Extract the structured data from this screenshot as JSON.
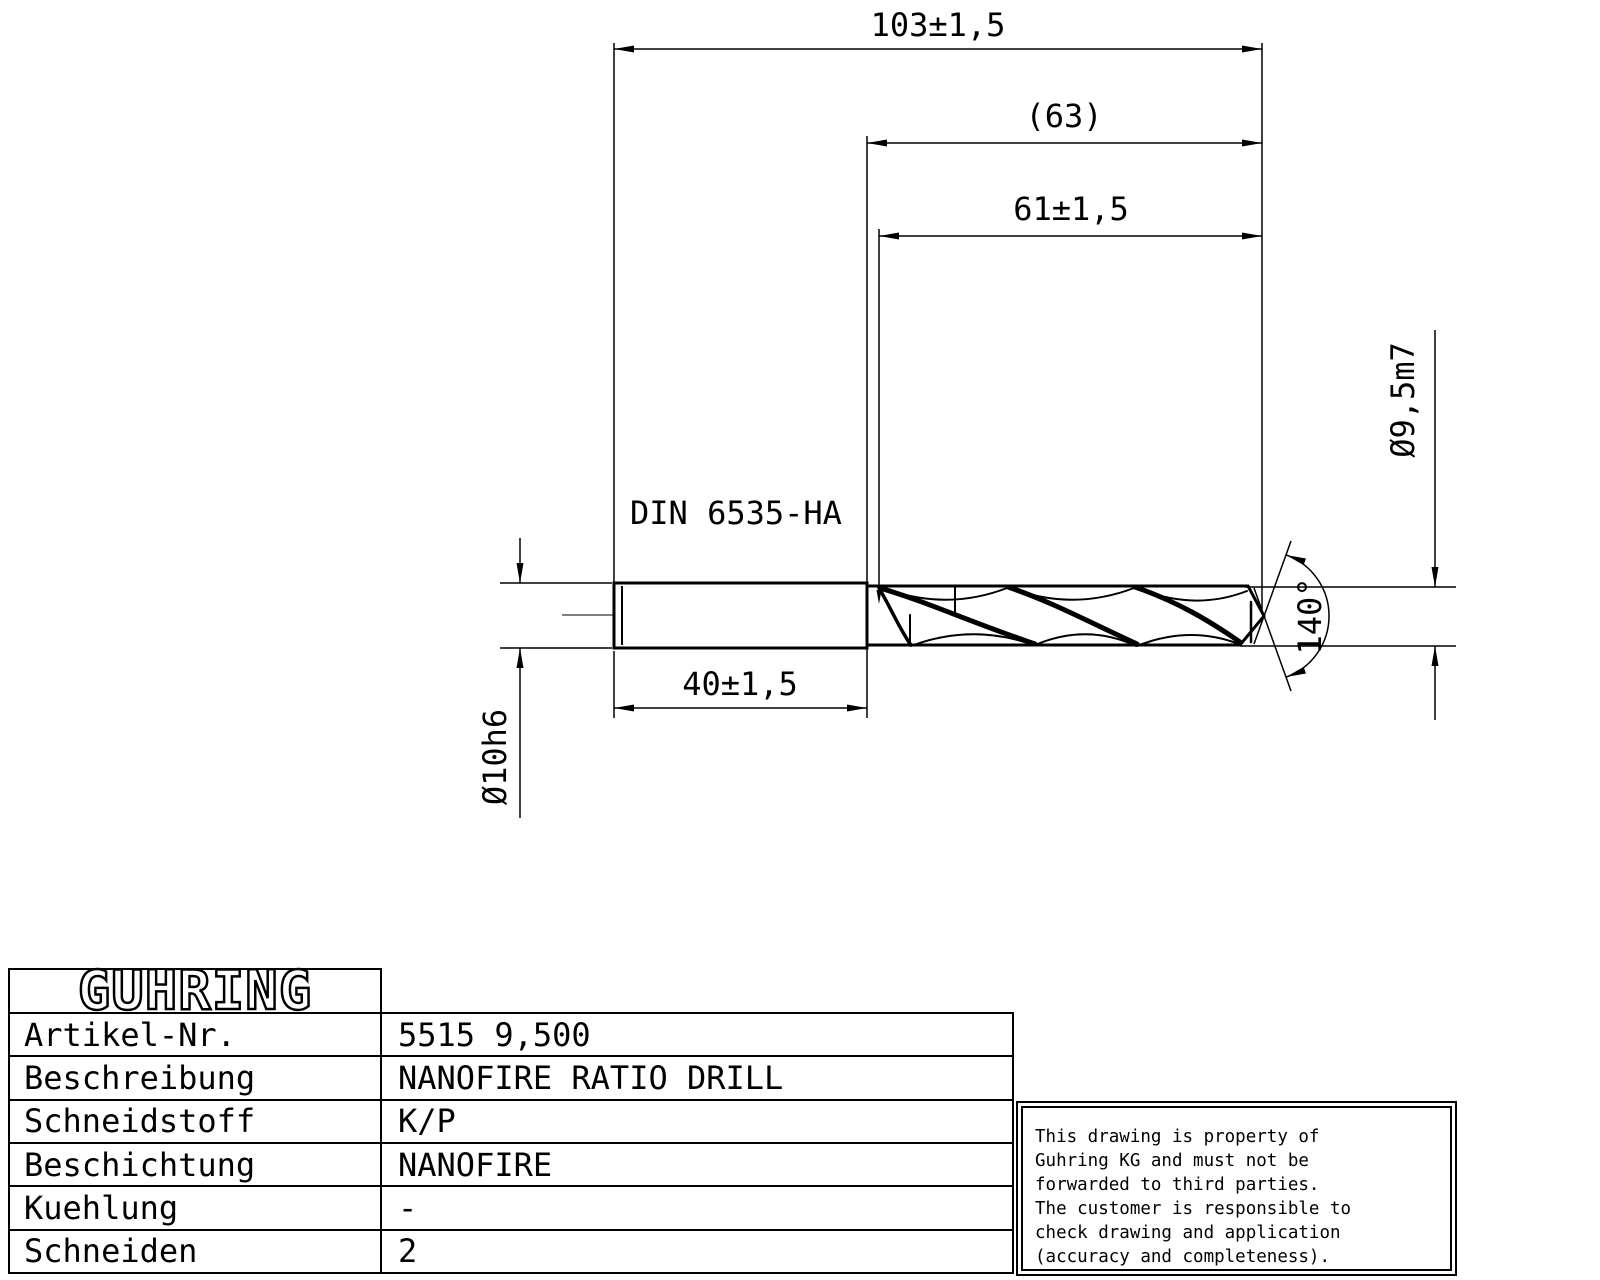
{
  "drawing": {
    "shank_standard": "DIN 6535-HA",
    "dimensions": {
      "overall_length": "103±1,5",
      "reference_length": "(63)",
      "flute_length": "61±1,5",
      "shank_length": "40±1,5",
      "shank_diameter": "Ø10h6",
      "cutting_diameter": "Ø9,5m7",
      "point_angle": "140°"
    }
  },
  "title_block": {
    "logo": "GUHRING",
    "rows": [
      {
        "label": "Artikel-Nr.",
        "value": "5515 9,500"
      },
      {
        "label": "Beschreibung",
        "value": "NANOFIRE RATIO DRILL"
      },
      {
        "label": "Schneidstoff",
        "value": "K/P"
      },
      {
        "label": "Beschichtung",
        "value": "NANOFIRE"
      },
      {
        "label": "Kuehlung",
        "value": "-"
      },
      {
        "label": "Schneiden",
        "value": "2"
      }
    ]
  },
  "disclaimer": {
    "lines": [
      "This drawing is property of",
      "Guhring KG and must not be",
      "forwarded to third parties.",
      "The customer is responsible to",
      "check drawing and application",
      "(accuracy and completeness)."
    ]
  },
  "colors": {
    "ink": "#000000",
    "paper": "#ffffff"
  }
}
